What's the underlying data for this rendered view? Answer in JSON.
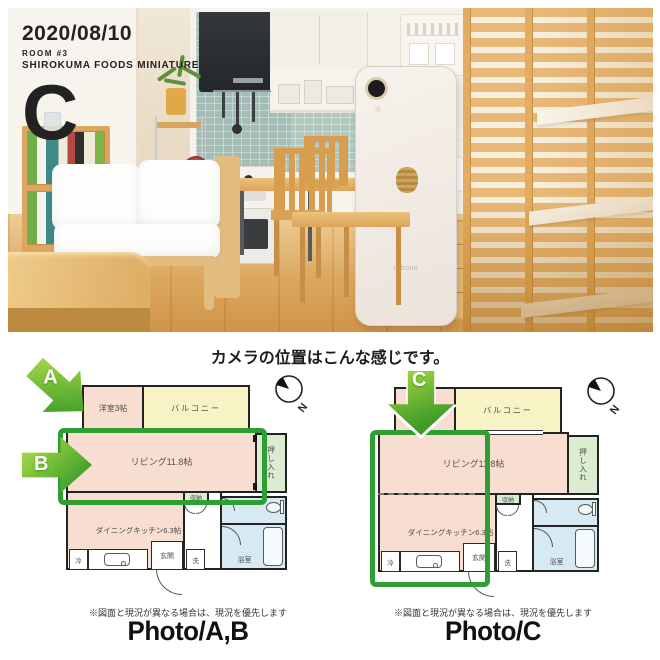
{
  "header": {
    "date": "2020/08/10",
    "room_no": "ROOM #3",
    "brand": "SHIROKUMA FOODS MINIATURE",
    "photo_letter": "C"
  },
  "caption": "カメラの位置はこんな感じです。",
  "photo": {
    "iphone_text": "iPhone"
  },
  "plans": {
    "left": {
      "rooms": {
        "western": "洋室3帖",
        "balcony": "バルコニー",
        "living": "リビング11.8帖",
        "closet": "押し入れ",
        "storage": "収納",
        "dining": "ダイニングキッチン6.3帖",
        "fridge": "冷",
        "entrance": "玄関",
        "wash": "洗",
        "bath": "浴室"
      },
      "compass_n": "N",
      "arrows": {
        "a": "A",
        "b": "B"
      },
      "note": "※図面と現況が異なる場合は、現況を優先します",
      "caption": "Photo/A,B"
    },
    "right": {
      "rooms": {
        "balcony": "バルコニー",
        "living": "リビング11.8帖",
        "closet": "押し入れ",
        "storage": "収納",
        "dining": "ダイニングキッチン6.3帖",
        "fridge": "冷",
        "entrance": "玄関",
        "wash": "洗",
        "bath": "浴室"
      },
      "compass_n": "N",
      "arrows": {
        "c": "C"
      },
      "note": "※図面と現況が異なる場合は、現況を優先します",
      "caption": "Photo/C"
    }
  },
  "colors": {
    "room_pink": "#f8ddd1",
    "balcony_yellow": "#f8f3c5",
    "closet_green": "#daecd1",
    "bath_blue": "#d7e9f3",
    "highlight_green": "#2f9e33",
    "arrow_green": "#48a42d"
  }
}
